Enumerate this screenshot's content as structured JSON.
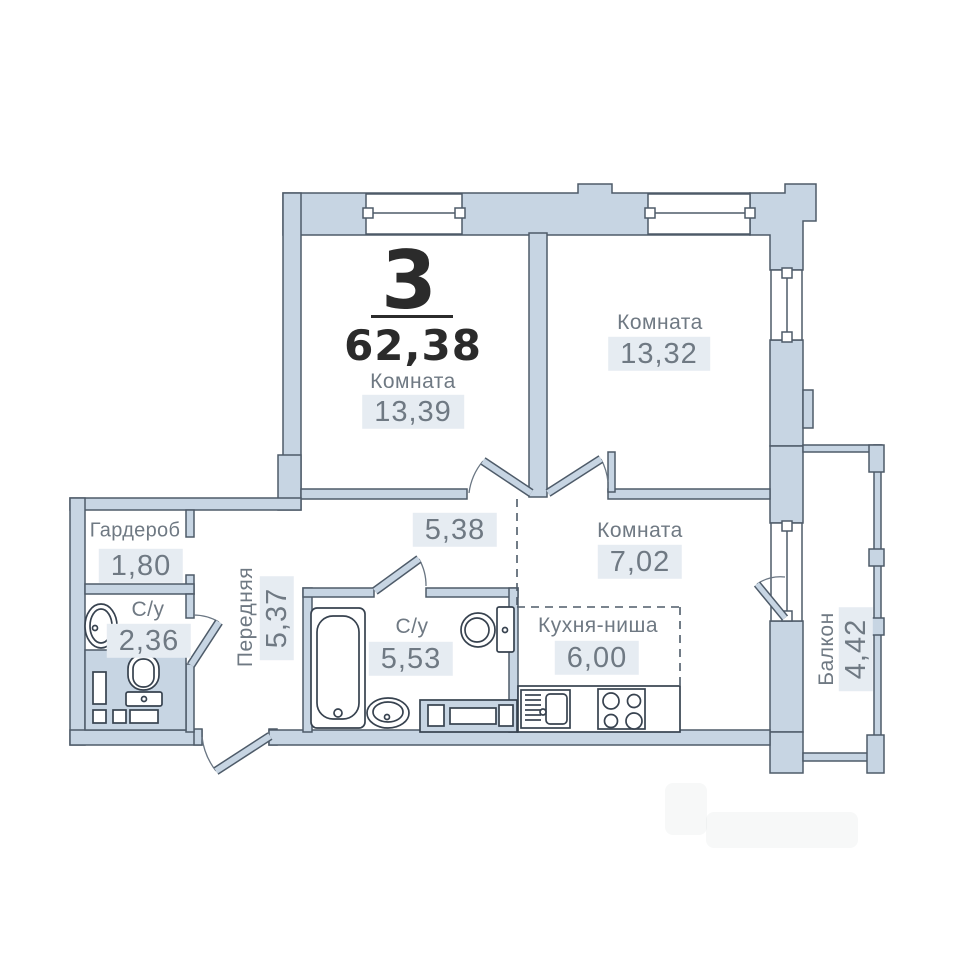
{
  "unit": {
    "rooms_count": "3",
    "total_area": "62,38"
  },
  "rooms": {
    "room1": {
      "name": "Комната",
      "area": "13,39"
    },
    "room2": {
      "name": "Комната",
      "area": "13,32"
    },
    "room3": {
      "name": "Комната",
      "area": "7,02"
    },
    "corridor": {
      "area": "5,38"
    },
    "hall": {
      "name": "Передняя",
      "area": "5,37"
    },
    "wardrobe": {
      "name": "Гардероб",
      "area": "1,80"
    },
    "bathroom_small": {
      "name": "С/у",
      "area": "2,36"
    },
    "bathroom_large": {
      "name": "С/у",
      "area": "5,53"
    },
    "kitchen_niche": {
      "name": "Кухня-ниша",
      "area": "6,00"
    },
    "balcony": {
      "name": "Балкон",
      "area": "4,42"
    }
  },
  "colors": {
    "wall_fill": "#c7d5e3",
    "wall_stroke": "#4e5b69",
    "fixture_stroke": "#37424f",
    "area_box_bg": "#e6ecf2",
    "label_text": "#6f7983",
    "title_text": "#2b2b2b"
  }
}
